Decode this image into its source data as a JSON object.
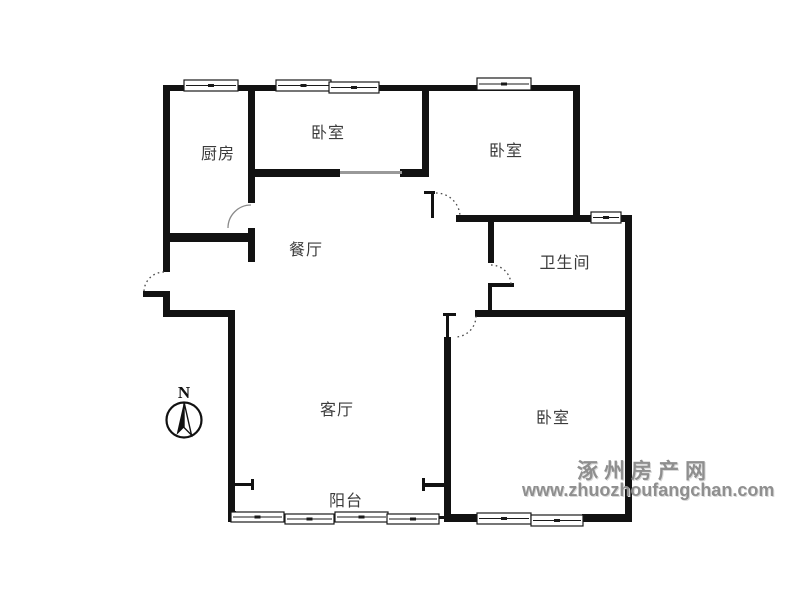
{
  "canvas": {
    "width": 800,
    "height": 600,
    "background": "#ffffff",
    "wall_color": "#121212",
    "thin_color": "#999999",
    "label_color": "#3b3b3b"
  },
  "rooms": {
    "kitchen": {
      "label": "厨房",
      "cx": 218,
      "cy": 152
    },
    "bedroom_top": {
      "label": "卧室",
      "cx": 328,
      "cy": 131
    },
    "bedroom_right": {
      "label": "卧室",
      "cx": 506,
      "cy": 149
    },
    "dining": {
      "label": "餐厅",
      "cx": 306,
      "cy": 248
    },
    "bathroom": {
      "label": "卫生间",
      "cx": 565,
      "cy": 261
    },
    "living": {
      "label": "客厅",
      "cx": 337,
      "cy": 408
    },
    "bedroom_bottom": {
      "label": "卧室",
      "cx": 553,
      "cy": 416
    },
    "balcony": {
      "label": "阳台",
      "cx": 346,
      "cy": 499
    }
  },
  "compass": {
    "label": "N"
  },
  "watermark": {
    "site_name": "涿州房产网",
    "url": "www.zhuozhoufangchan.com",
    "color": "#8f8f8f"
  },
  "plan": {
    "walls": [
      [
        163,
        85,
        417,
        6
      ],
      [
        163,
        85,
        7,
        187
      ],
      [
        143,
        291,
        27,
        6
      ],
      [
        163,
        291,
        7,
        22
      ],
      [
        163,
        310,
        72,
        7
      ],
      [
        228,
        310,
        7,
        208
      ],
      [
        228,
        511,
        8,
        11
      ],
      [
        230,
        516,
        215,
        3
      ],
      [
        573,
        85,
        7,
        137
      ],
      [
        456,
        215,
        137,
        7
      ],
      [
        619,
        215,
        13,
        7
      ],
      [
        625,
        218,
        7,
        304
      ],
      [
        475,
        310,
        157,
        7
      ],
      [
        488,
        218,
        6,
        45
      ],
      [
        488,
        283,
        26,
        4
      ],
      [
        488,
        283,
        4,
        30
      ],
      [
        248,
        85,
        7,
        118
      ],
      [
        163,
        233,
        92,
        9
      ],
      [
        248,
        228,
        7,
        34
      ],
      [
        248,
        169,
        92,
        8
      ],
      [
        400,
        169,
        29,
        8
      ],
      [
        422,
        85,
        7,
        92
      ],
      [
        424,
        191,
        11,
        3
      ],
      [
        431,
        191,
        3,
        27
      ],
      [
        443,
        313,
        13,
        3
      ],
      [
        446,
        316,
        3,
        21
      ],
      [
        444,
        337,
        7,
        181
      ],
      [
        235,
        483,
        19,
        3
      ],
      [
        251,
        479,
        3,
        11
      ],
      [
        423,
        483,
        23,
        4
      ],
      [
        422,
        478,
        3,
        13
      ],
      [
        444,
        514,
        36,
        8
      ],
      [
        582,
        514,
        50,
        8
      ]
    ],
    "gray_lines": [
      [
        340,
        171,
        62,
        3
      ]
    ],
    "windows": [
      [
        184,
        80,
        54,
        11
      ],
      [
        276,
        80,
        55,
        11
      ],
      [
        329,
        82,
        50,
        11
      ],
      [
        477,
        78,
        54,
        12
      ],
      [
        591,
        212,
        30,
        11
      ],
      [
        231,
        512,
        53,
        10
      ],
      [
        285,
        514,
        49,
        10
      ],
      [
        335,
        512,
        53,
        10
      ],
      [
        387,
        514,
        52,
        10
      ],
      [
        477,
        513,
        54,
        11
      ],
      [
        531,
        515,
        52,
        11
      ]
    ],
    "arcs": [
      {
        "x1": 164,
        "y1": 272,
        "x2": 144,
        "y2": 292,
        "r": 20,
        "sweep": 0,
        "dotted": true
      },
      {
        "x1": 251,
        "y1": 205,
        "x2": 228,
        "y2": 228,
        "r": 23,
        "sweep": 0,
        "dotted": false
      },
      {
        "x1": 491,
        "y1": 265,
        "x2": 511,
        "y2": 285,
        "r": 20,
        "sweep": 1,
        "dotted": true
      },
      {
        "x1": 436,
        "y1": 193,
        "x2": 460,
        "y2": 217,
        "r": 24,
        "sweep": 1,
        "dotted": true
      },
      {
        "x1": 476,
        "y1": 316,
        "x2": 455,
        "y2": 337,
        "r": 21,
        "sweep": 1,
        "dotted": true
      }
    ]
  }
}
